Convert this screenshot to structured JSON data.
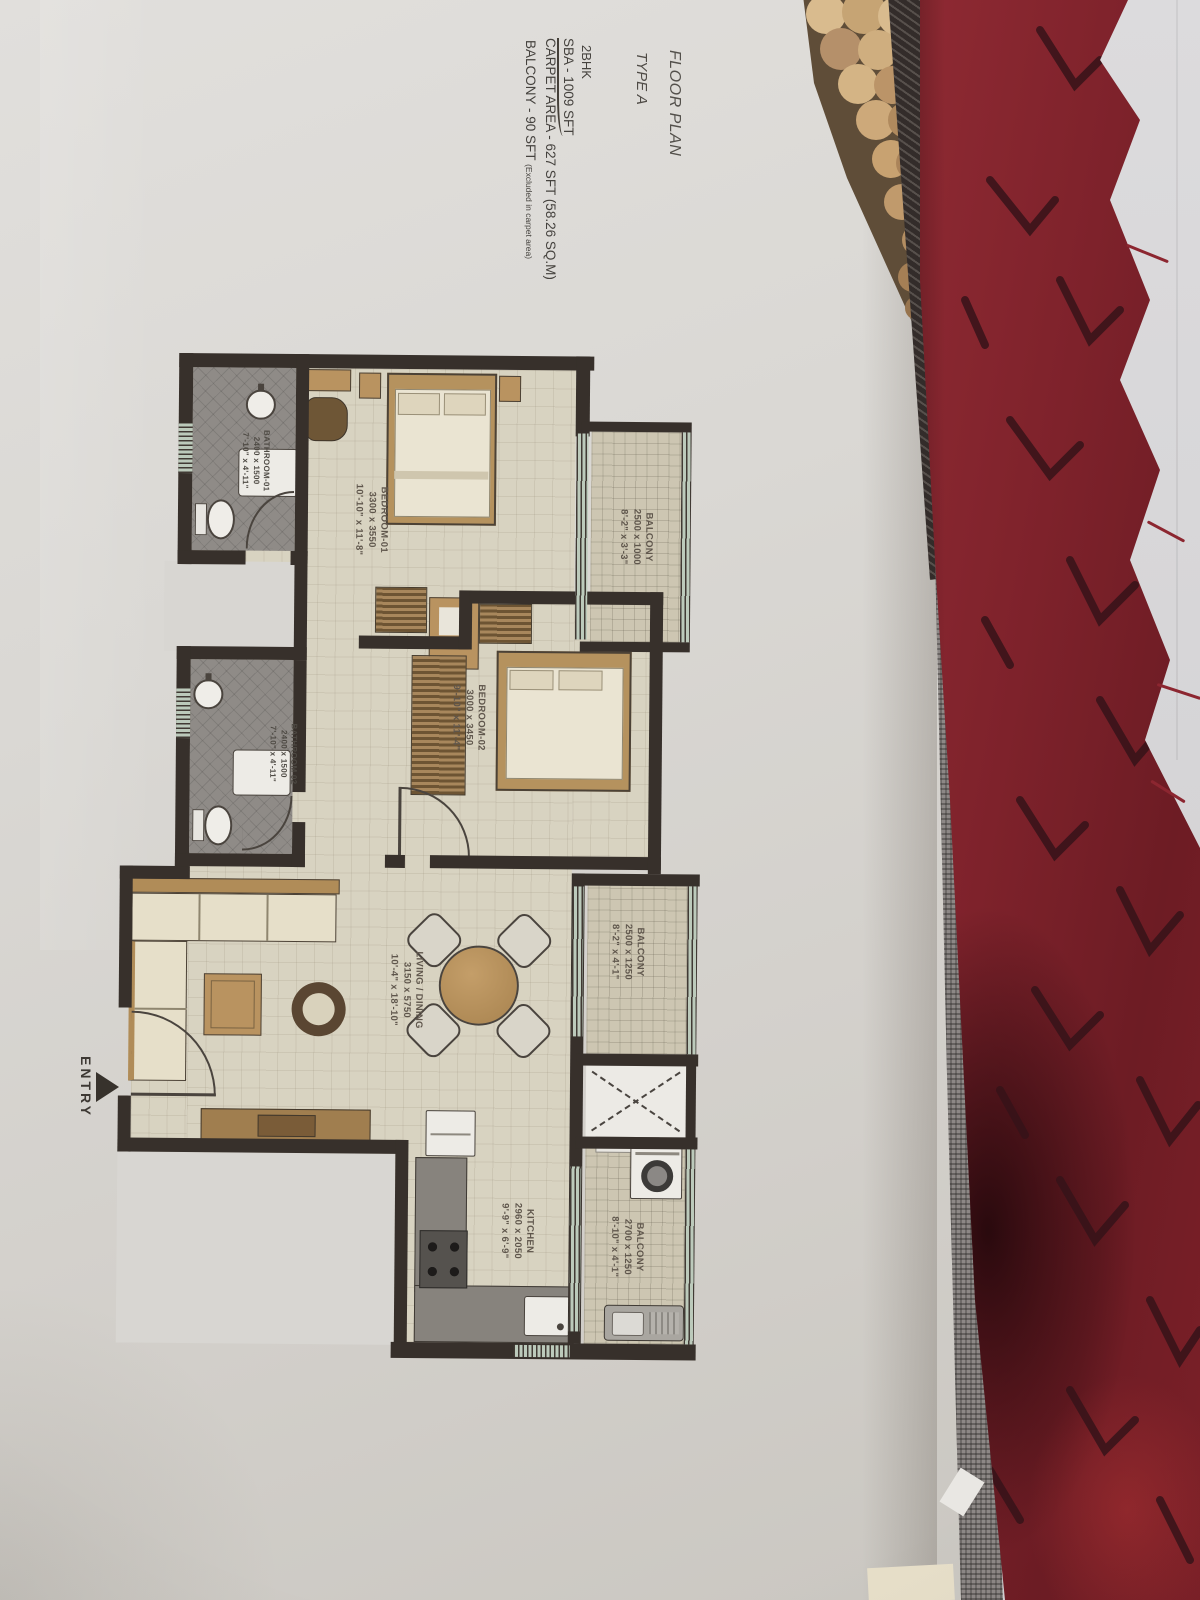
{
  "title_block": {
    "title": "FLOOR PLAN",
    "type": "TYPE A",
    "config": "2BHK",
    "sba": "SBA - 1009 SFT",
    "carpet": "CARPET AREA - 627 SFT (58.26 SQ.M)",
    "balcony": "BALCONY - 90 SFT",
    "balcony_note": "(Excluded in carpet area)"
  },
  "entry_label": "ENTRY",
  "rooms": [
    {
      "name": "BALCONY",
      "dim_mm": "2500 x 1000",
      "dim_ft": "8'-2\" x 3'-3\""
    },
    {
      "name": "BEDROOM-01",
      "dim_mm": "3300 x 3550",
      "dim_ft": "10'-10\" x 11'-8\""
    },
    {
      "name": "BATHROOM-01",
      "dim_mm": "2400 x 1500",
      "dim_ft": "7'-10\" x 4'-11\""
    },
    {
      "name": "BEDROOM-02",
      "dim_mm": "3000 x 3450",
      "dim_ft": "9'-10\" x 11'-4\""
    },
    {
      "name": "BATHROOM 02",
      "dim_mm": "2400 x 1500",
      "dim_ft": "7'-10\" x 4'-11\""
    },
    {
      "name": "LIVING / DINING",
      "dim_mm": "3150 x 5750",
      "dim_ft": "10'-4\" x 18'-10\""
    },
    {
      "name": "BALCONY",
      "dim_mm": "2500 x 1250",
      "dim_ft": "8'-2\" x 4'-1\""
    },
    {
      "name": "KITCHEN",
      "dim_mm": "2960 x 2050",
      "dim_ft": "9'-9\" x 6'-9\""
    },
    {
      "name": "BALCONY",
      "dim_mm": "2700 x 1250",
      "dim_ft": "8'-10\" x 4'-1\""
    }
  ],
  "colors": {
    "paper": "#dbd9d6",
    "plan_wall": "#37302b",
    "floor_beige": "#d8d3c1",
    "tile_grey": "#8f8b87",
    "balcony_tile": "#cdc6b2",
    "window_teal": "#bccabb",
    "label_text": "#5f564c",
    "fabric_red": "#8c2630",
    "fabric_grey_band": "#8d8886",
    "fringe_tan": "#d2b285"
  }
}
